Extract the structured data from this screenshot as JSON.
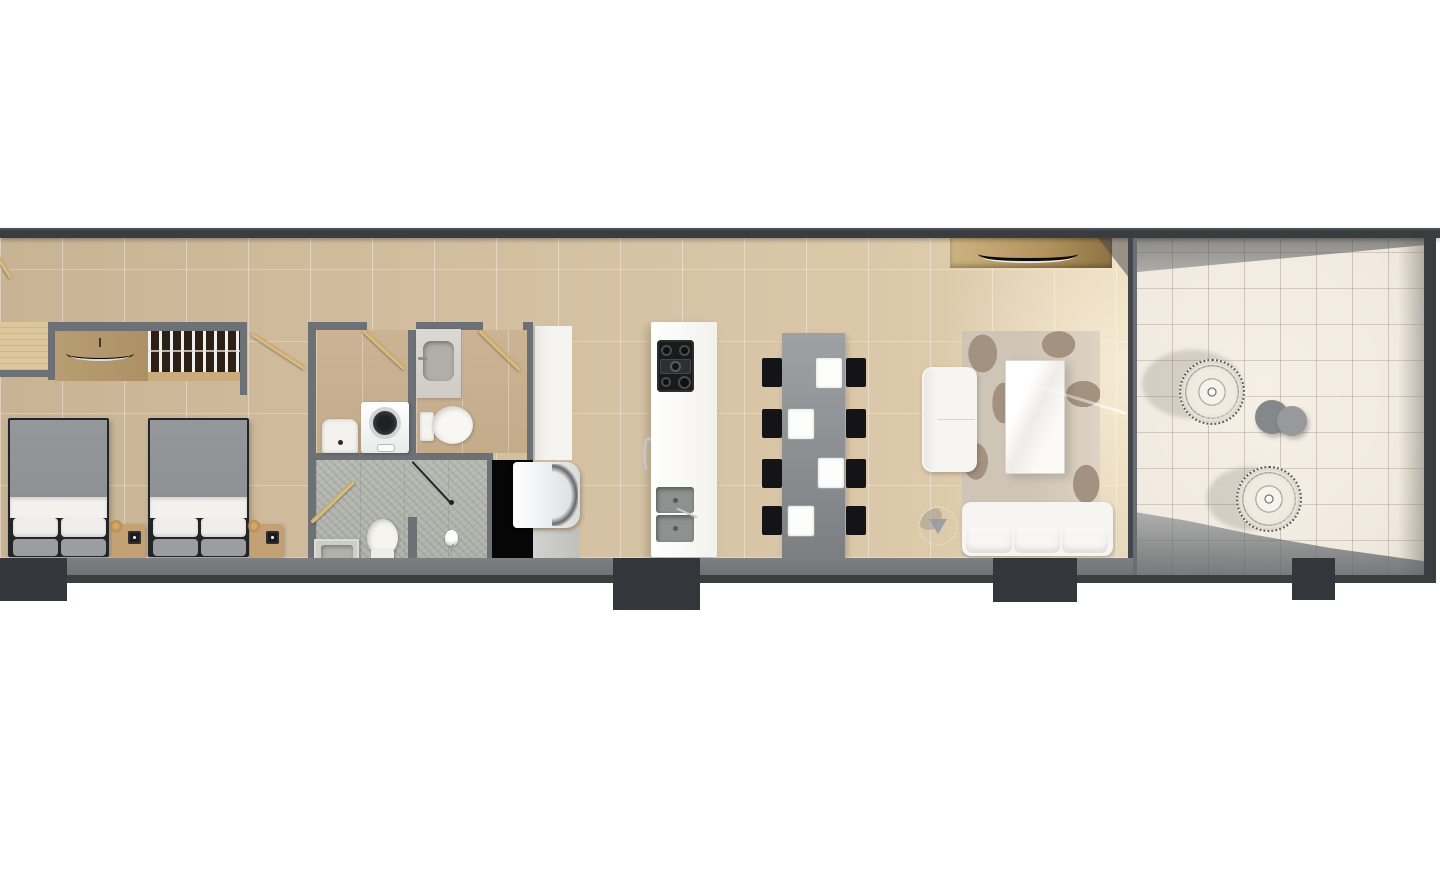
{
  "meta": {
    "title": "Apartment floor plan - top-down 3D architectural render",
    "view": "top-down",
    "background": "white"
  },
  "palette": {
    "wallDark": "#3a3d40",
    "wallMid": "#6d7175",
    "bandGray": "#77797c",
    "stubDark": "#33363a",
    "lineDark": "#3b3e41",
    "bathFloor": "#cbb394",
    "terraceTile": "#f1eae0",
    "wood": "#c9a76c",
    "woodLight": "#dcc69c",
    "woodMid": "#b99d72",
    "woodDark": "#6b4f33",
    "shelfWood": "#c9ab7e",
    "nightWood": "#c2a274",
    "furnWhite": "#f6f5f2",
    "duvetGray": "#8e9193",
    "pillowGray": "#9b9da0",
    "bedFrame": "#232426",
    "stoneFloor": "#b6b9b1",
    "voidBlack": "#060606",
    "counterWhite": "#f4f3ef",
    "steel": "#d9dbdc",
    "hobBlack": "#191a1b",
    "basinGray": "#8d918f",
    "tableGray": "#8f9294",
    "chairBlack": "#141416",
    "rugBase": "#cfc5b7",
    "rugPat": "#a3927f",
    "poufDark": "#85888a",
    "poufLight": "#97999b",
    "glassLine": "#43464a"
  },
  "rooms": [
    {
      "id": "entry-hall",
      "label": "Entry hallway",
      "furniture": [
        "entry-door",
        "wood-console"
      ]
    },
    {
      "id": "bedroom",
      "label": "Bedroom",
      "furniture": [
        "wardrobe-hanging-rail",
        "dresser-with-tv",
        "bed-1",
        "bed-2",
        "nightstand-1",
        "nightstand-2"
      ]
    },
    {
      "id": "laundry-bathroom",
      "label": "Laundry bathroom",
      "furniture": [
        "laundry-basin",
        "washing-machine"
      ]
    },
    {
      "id": "guest-bathroom",
      "label": "Guest bathroom",
      "furniture": [
        "vanity-sink",
        "toilet"
      ]
    },
    {
      "id": "shower-room",
      "label": "Shower room",
      "furniture": [
        "glass-shower-door",
        "toilet",
        "vanity-sink",
        "hand-shower"
      ]
    },
    {
      "id": "kitchen",
      "label": "Kitchen",
      "furniture": [
        "counter",
        "refrigerator",
        "island",
        "gas-hob",
        "double-sink"
      ]
    },
    {
      "id": "dining",
      "label": "Dining area",
      "furniture": [
        "dining-table",
        "eight-chairs",
        "four-place-settings"
      ]
    },
    {
      "id": "living",
      "label": "Living room",
      "furniture": [
        "tv-console",
        "curved-tv",
        "area-rug",
        "loveseat",
        "coffee-table",
        "sofa",
        "round-lounge-chair"
      ]
    },
    {
      "id": "terrace",
      "label": "Terrace",
      "furniture": [
        "wicker-chair-1",
        "wicker-chair-2",
        "pouf-1",
        "pouf-2"
      ]
    }
  ]
}
